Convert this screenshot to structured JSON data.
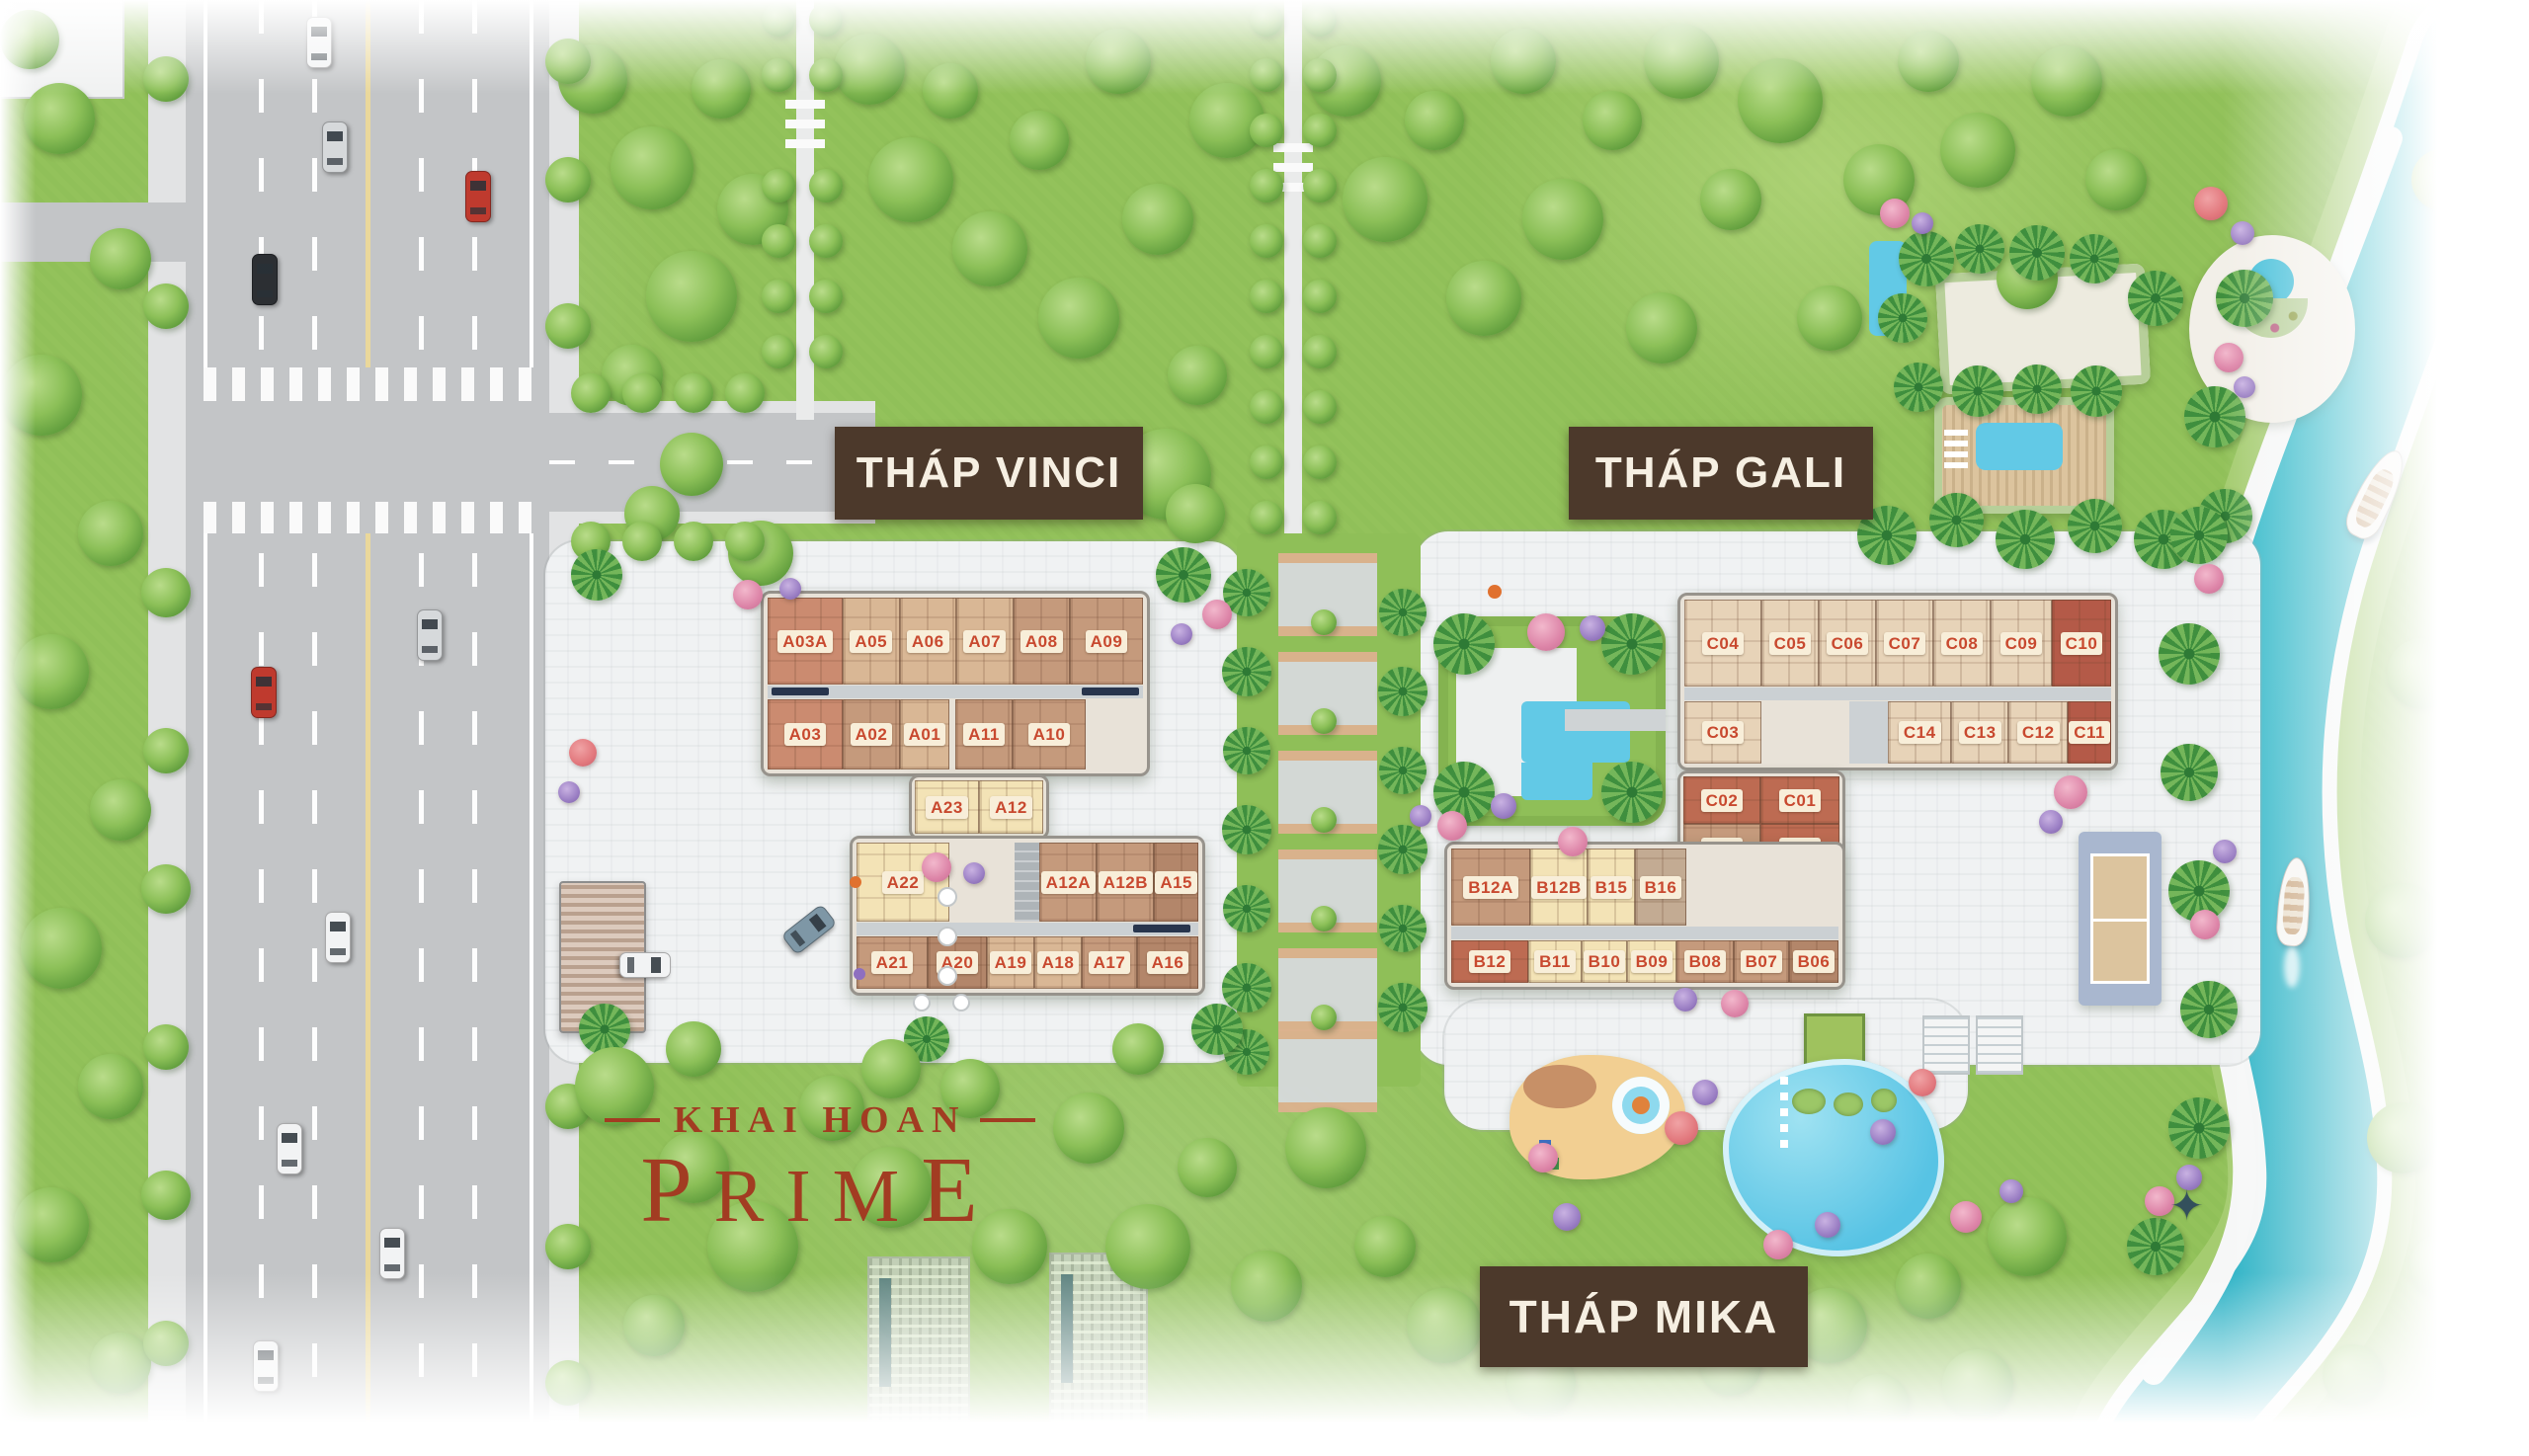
{
  "brand": {
    "top": "KHAI HOAN",
    "main": "PRIME"
  },
  "colors": {
    "chip_bg": "#f8eed9",
    "chip_text": "#c8492f",
    "tower_label_bg": "#4c392b",
    "tower_label_text": "#f6efe2",
    "river": "#2fb7c6",
    "brand_red": "#a23c22"
  },
  "blocks": {
    "vinci": {
      "label": "THÁP VINCI",
      "row1": [
        {
          "id": "A03A",
          "tone": "rosy",
          "w": 76
        },
        {
          "id": "A05",
          "tone": "tan"
        },
        {
          "id": "A06",
          "tone": "tan"
        },
        {
          "id": "A07",
          "tone": "tan"
        },
        {
          "id": "A08",
          "tone": "brown"
        },
        {
          "id": "A09",
          "tone": "brown",
          "w": 74
        }
      ],
      "row2": [
        {
          "id": "A03",
          "tone": "rosy",
          "w": 76
        },
        {
          "id": "A02",
          "tone": "brown",
          "w": 58
        },
        {
          "id": "A01",
          "tone": "tan",
          "w": 50
        }
      ],
      "row2b": [
        {
          "id": "A11",
          "tone": "brown",
          "w": 58
        },
        {
          "id": "A10",
          "tone": "brown",
          "w": 74
        }
      ],
      "mid": [
        {
          "id": "A23",
          "tone": "cream"
        },
        {
          "id": "A12",
          "tone": "cream"
        }
      ],
      "row3_left": [
        {
          "id": "A22",
          "tone": "cream",
          "w": 94
        }
      ],
      "row3_right": [
        {
          "id": "A12A",
          "tone": "brown",
          "w": 58
        },
        {
          "id": "A12B",
          "tone": "brown",
          "w": 58
        },
        {
          "id": "A15",
          "tone": "dark"
        }
      ],
      "row4": [
        {
          "id": "A21",
          "tone": "brown",
          "w": 72
        },
        {
          "id": "A20",
          "tone": "dark",
          "w": 60
        },
        {
          "id": "A19",
          "tone": "tan",
          "w": 48
        },
        {
          "id": "A18",
          "tone": "tan",
          "w": 48
        },
        {
          "id": "A17",
          "tone": "brown",
          "w": 56
        },
        {
          "id": "A16",
          "tone": "dark"
        }
      ]
    },
    "gali": {
      "label": "THÁP GALI",
      "c_row1": [
        {
          "id": "C04",
          "tone": "beige",
          "w": 78
        },
        {
          "id": "C05",
          "tone": "beige",
          "w": 58
        },
        {
          "id": "C06",
          "tone": "beige",
          "w": 58
        },
        {
          "id": "C07",
          "tone": "beige",
          "w": 58
        },
        {
          "id": "C08",
          "tone": "beige",
          "w": 58
        },
        {
          "id": "C09",
          "tone": "beige",
          "w": 62
        },
        {
          "id": "C10",
          "tone": "red"
        }
      ],
      "c_row2a": [
        {
          "id": "C03",
          "tone": "beige",
          "w": 78
        }
      ],
      "c_row2b": [
        {
          "id": "C14",
          "tone": "beige",
          "w": 64
        },
        {
          "id": "C13",
          "tone": "beige",
          "w": 58
        },
        {
          "id": "C12",
          "tone": "beige",
          "w": 60
        },
        {
          "id": "C11",
          "tone": "red"
        }
      ],
      "wing_r1": [
        {
          "id": "C02",
          "tone": "rust",
          "w": 78
        },
        {
          "id": "C01",
          "tone": "rust"
        }
      ],
      "wing_r2": [
        {
          "id": "B02",
          "tone": "brown",
          "w": 78
        },
        {
          "id": "B03",
          "tone": "rust"
        }
      ],
      "wing_r3": [
        {
          "id": "B01",
          "tone": "brown",
          "w": 78
        },
        {
          "id": "B03A",
          "tone": "dark"
        }
      ],
      "wing_r4": [
        {
          "id": "B05",
          "tone": "brown"
        }
      ],
      "b_row1": [
        {
          "id": "B12A",
          "tone": "brown",
          "w": 80
        },
        {
          "id": "B12B",
          "tone": "cream",
          "w": 58
        },
        {
          "id": "B15",
          "tone": "cream",
          "w": 48
        },
        {
          "id": "B16",
          "tone": "taupe",
          "w": 52
        }
      ],
      "b_row2": [
        {
          "id": "B12",
          "tone": "rust",
          "w": 78
        },
        {
          "id": "B11",
          "tone": "cream",
          "w": 54
        },
        {
          "id": "B10",
          "tone": "cream",
          "w": 46
        },
        {
          "id": "B09",
          "tone": "cream",
          "w": 50
        },
        {
          "id": "B08",
          "tone": "brown",
          "w": 58
        },
        {
          "id": "B07",
          "tone": "brown",
          "w": 56
        },
        {
          "id": "B06",
          "tone": "dark"
        }
      ]
    },
    "mika": {
      "label": "THÁP MIKA"
    }
  }
}
